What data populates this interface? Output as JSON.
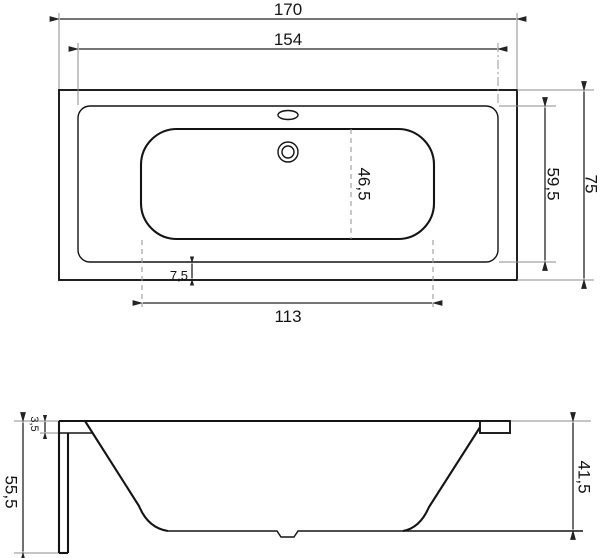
{
  "drawing": {
    "type": "bathtub technical drawing, top view and side section view",
    "colors": {
      "background": "#ffffff",
      "object_line": "#141414",
      "dimension_line": "#232323",
      "extension_line": "#8d8d8d",
      "dashed_line": "#9a9a9a"
    },
    "dimensions": {
      "top_view": {
        "overall_length": "170",
        "inner_length": "154",
        "overall_width": "75",
        "rim_opening_width": "59,5",
        "floor_width": "46,5",
        "rim_width": "7,5",
        "floor_length": "113"
      },
      "side_view": {
        "overall_height": "55,5",
        "rim_thickness": "3,5",
        "inner_depth": "41,5"
      }
    }
  }
}
